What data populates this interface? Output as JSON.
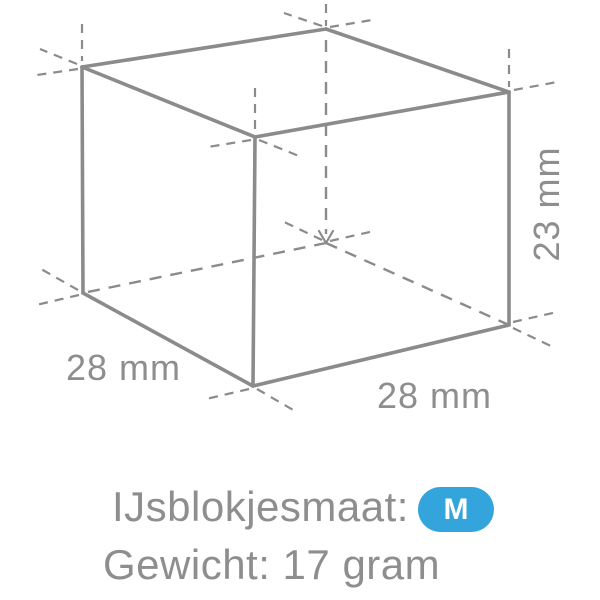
{
  "diagram": {
    "title": "ice-cube-dimension-drawing",
    "dimensions": {
      "width_label": "28 mm",
      "depth_label": "28 mm",
      "height_label": "23 mm"
    },
    "colors": {
      "line": "#8b8b8b",
      "text": "#8e8e8e",
      "badge_bg": "#34a5dc",
      "badge_text": "#ffffff"
    }
  },
  "info": {
    "size_label": "IJsblokjesmaat:",
    "size_value": "M",
    "weight_label": "Gewicht: 17 gram"
  }
}
